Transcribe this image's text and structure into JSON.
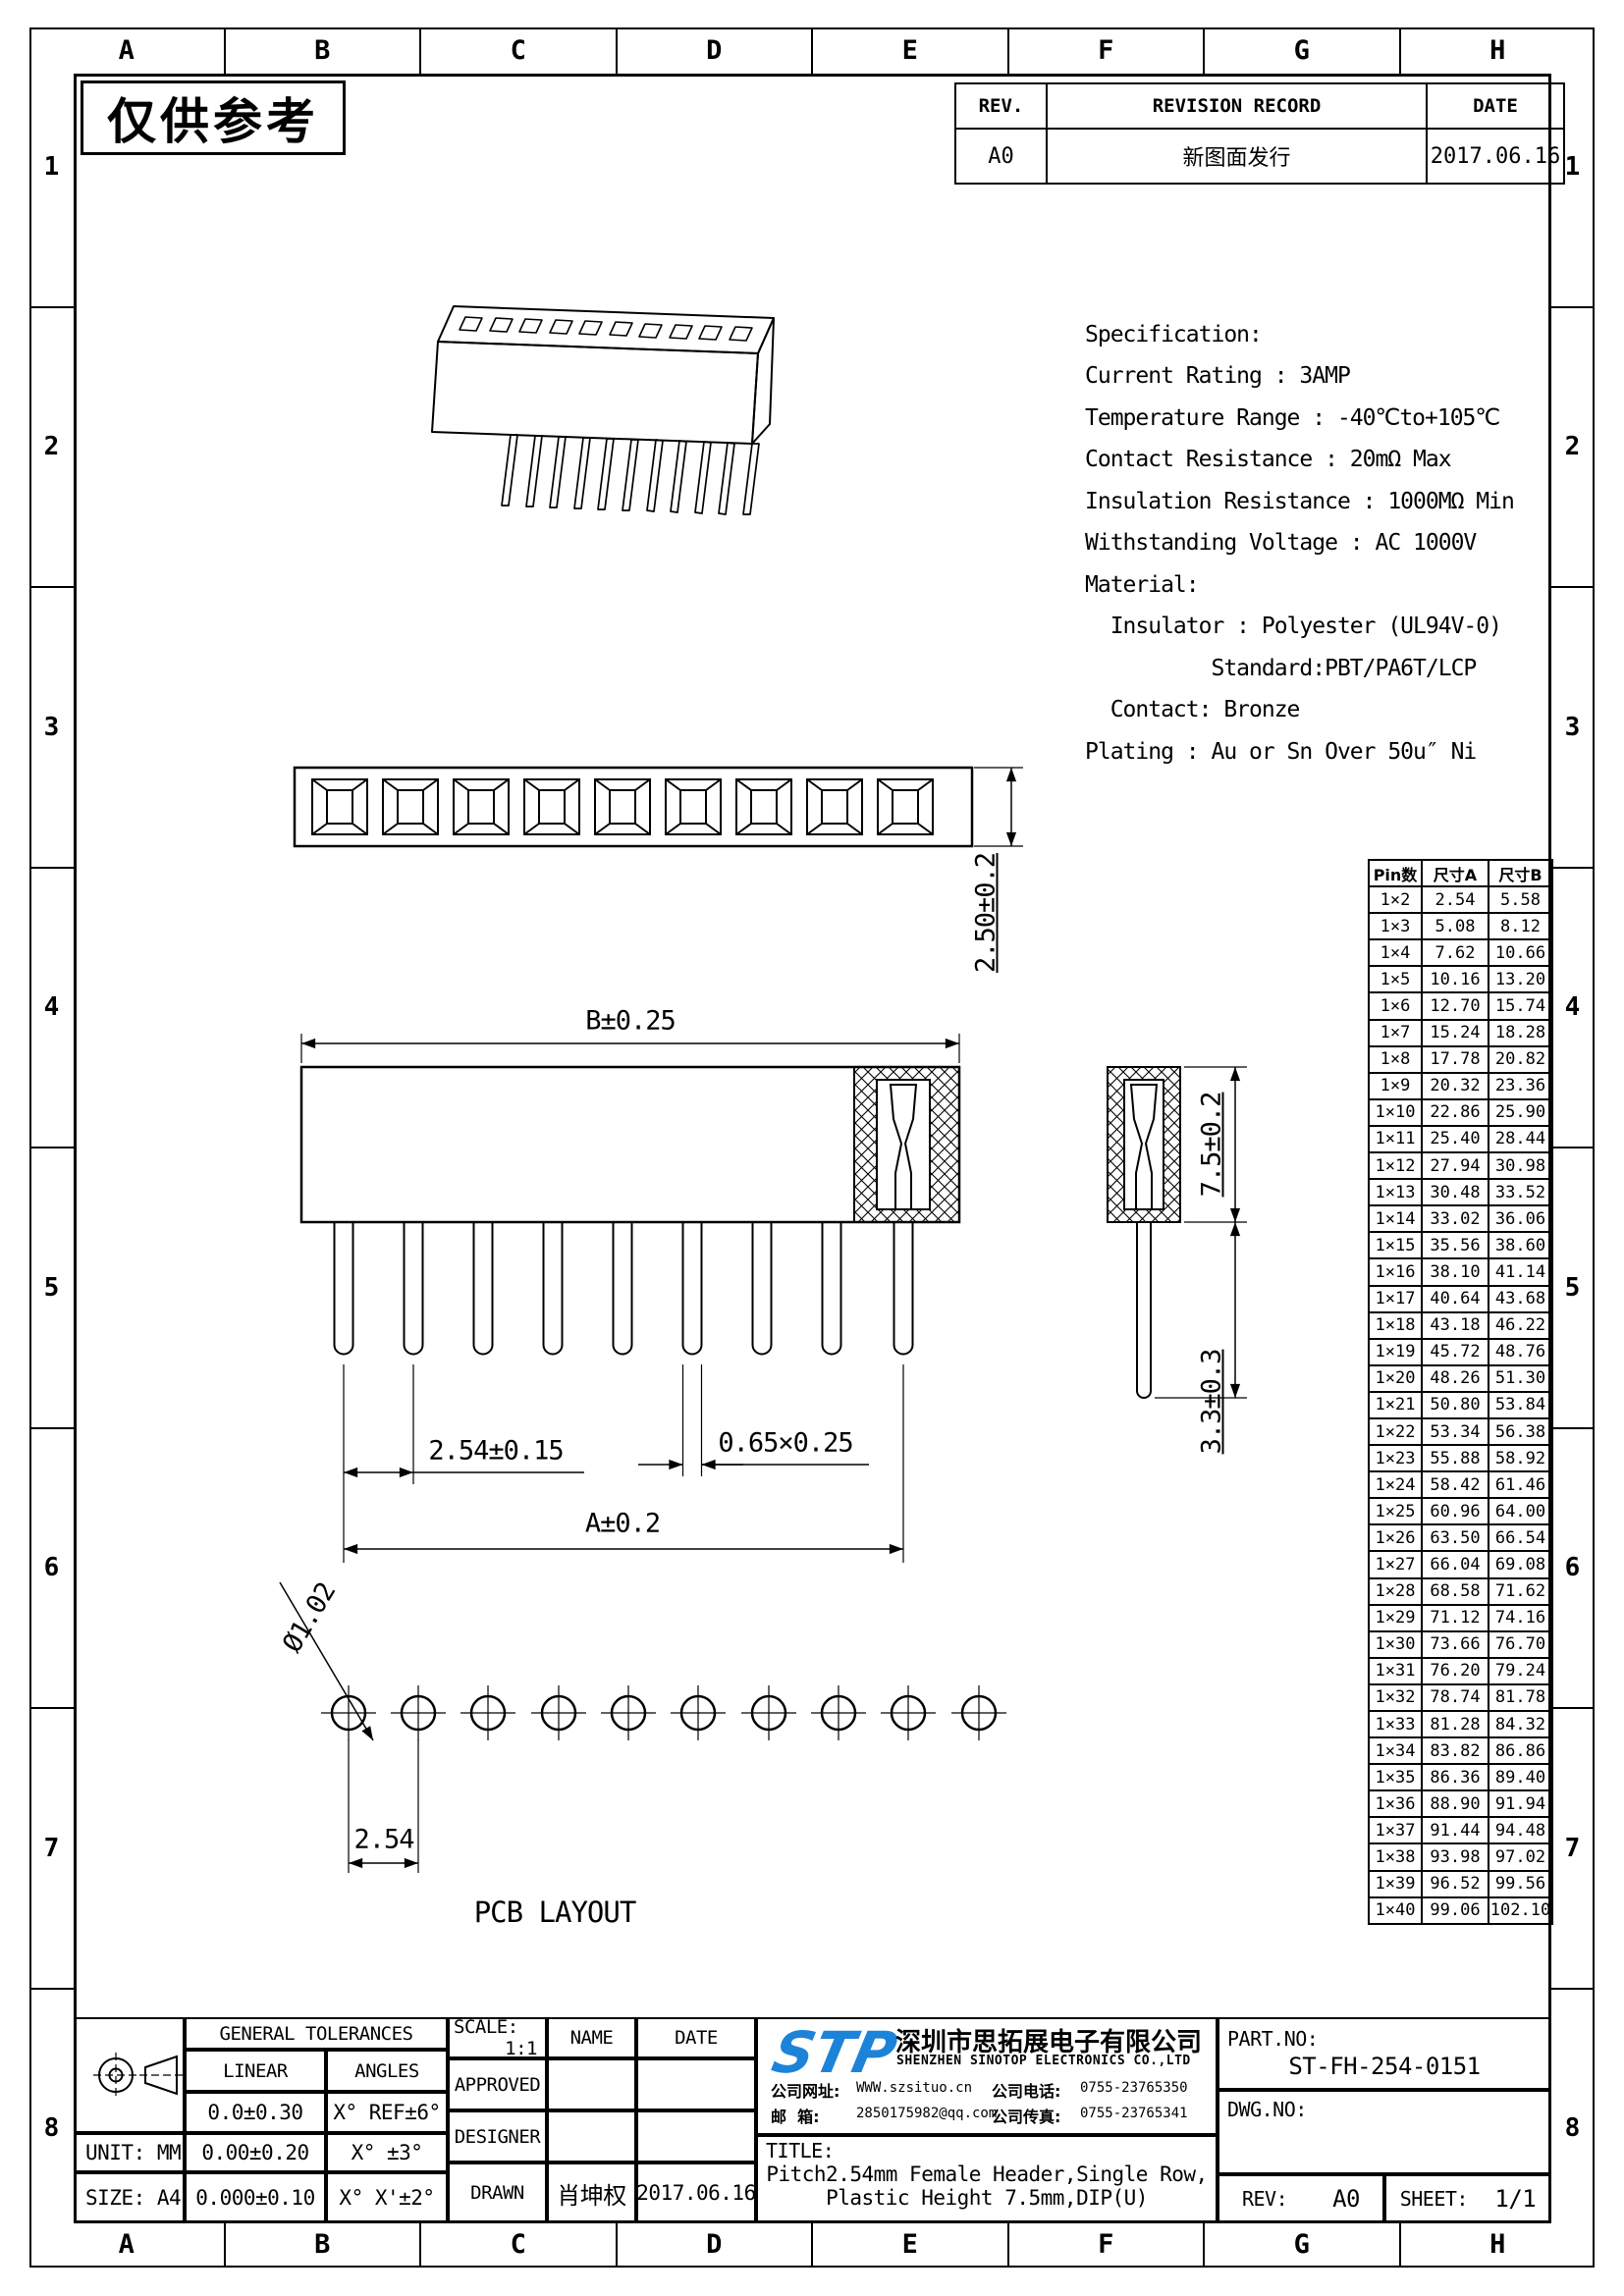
{
  "watermark": "仅供参考",
  "border": {
    "columns": [
      "A",
      "B",
      "C",
      "D",
      "E",
      "F",
      "G",
      "H"
    ],
    "rows": [
      "1",
      "2",
      "3",
      "4",
      "5",
      "6",
      "7",
      "8"
    ]
  },
  "revision": {
    "headers": [
      "REV.",
      "REVISION RECORD",
      "DATE"
    ],
    "rows": [
      [
        "A0",
        "新图面发行",
        "2017.06.16"
      ]
    ]
  },
  "specification": {
    "lines": [
      "Specification:",
      "Current Rating : 3AMP",
      "Temperature Range : -40℃to+105℃",
      "Contact Resistance : 20mΩ Max",
      "Insulation Resistance : 1000MΩ Min",
      "Withstanding Voltage : AC 1000V",
      "Material:",
      "  Insulator : Polyester (UL94V-0)",
      "          Standard:PBT/PA6T/LCP",
      "  Contact: Bronze",
      "Plating : Au or Sn Over 50u″ Ni"
    ]
  },
  "dimensions": {
    "top_view_height": "2.50±0.2",
    "body_width": "B±0.25",
    "pitch": "2.54±0.15",
    "pin_section": "0.65×0.25",
    "overall": "A±0.2",
    "insulator_height": "7.5±0.2",
    "pin_length": "3.3±0.3",
    "hole_dia": "Ø1.02",
    "hole_pitch": "2.54",
    "pcb_label": "PCB LAYOUT"
  },
  "pin_table": {
    "headers": [
      "Pin数",
      "尺寸A",
      "尺寸B"
    ],
    "rows": [
      [
        "1×2",
        "2.54",
        "5.58"
      ],
      [
        "1×3",
        "5.08",
        "8.12"
      ],
      [
        "1×4",
        "7.62",
        "10.66"
      ],
      [
        "1×5",
        "10.16",
        "13.20"
      ],
      [
        "1×6",
        "12.70",
        "15.74"
      ],
      [
        "1×7",
        "15.24",
        "18.28"
      ],
      [
        "1×8",
        "17.78",
        "20.82"
      ],
      [
        "1×9",
        "20.32",
        "23.36"
      ],
      [
        "1×10",
        "22.86",
        "25.90"
      ],
      [
        "1×11",
        "25.40",
        "28.44"
      ],
      [
        "1×12",
        "27.94",
        "30.98"
      ],
      [
        "1×13",
        "30.48",
        "33.52"
      ],
      [
        "1×14",
        "33.02",
        "36.06"
      ],
      [
        "1×15",
        "35.56",
        "38.60"
      ],
      [
        "1×16",
        "38.10",
        "41.14"
      ],
      [
        "1×17",
        "40.64",
        "43.68"
      ],
      [
        "1×18",
        "43.18",
        "46.22"
      ],
      [
        "1×19",
        "45.72",
        "48.76"
      ],
      [
        "1×20",
        "48.26",
        "51.30"
      ],
      [
        "1×21",
        "50.80",
        "53.84"
      ],
      [
        "1×22",
        "53.34",
        "56.38"
      ],
      [
        "1×23",
        "55.88",
        "58.92"
      ],
      [
        "1×24",
        "58.42",
        "61.46"
      ],
      [
        "1×25",
        "60.96",
        "64.00"
      ],
      [
        "1×26",
        "63.50",
        "66.54"
      ],
      [
        "1×27",
        "66.04",
        "69.08"
      ],
      [
        "1×28",
        "68.58",
        "71.62"
      ],
      [
        "1×29",
        "71.12",
        "74.16"
      ],
      [
        "1×30",
        "73.66",
        "76.70"
      ],
      [
        "1×31",
        "76.20",
        "79.24"
      ],
      [
        "1×32",
        "78.74",
        "81.78"
      ],
      [
        "1×33",
        "81.28",
        "84.32"
      ],
      [
        "1×34",
        "83.82",
        "86.86"
      ],
      [
        "1×35",
        "86.36",
        "89.40"
      ],
      [
        "1×36",
        "88.90",
        "91.94"
      ],
      [
        "1×37",
        "91.44",
        "94.48"
      ],
      [
        "1×38",
        "93.98",
        "97.02"
      ],
      [
        "1×39",
        "96.52",
        "99.56"
      ],
      [
        "1×40",
        "99.06",
        "102.10"
      ]
    ]
  },
  "title_block": {
    "tolerances_title": "GENERAL TOLERANCES",
    "linear_header": "LINEAR",
    "angles_header": "ANGLES",
    "tolerance_rows": [
      [
        "0.0±0.30",
        "X° REF±6°"
      ],
      [
        "0.00±0.20",
        "X° ±3°"
      ],
      [
        "0.000±0.10",
        "X° X'±2°"
      ]
    ],
    "unit": "UNIT: MM",
    "size": "SIZE: A4",
    "scale_label": "SCALE:",
    "scale_value": "1:1",
    "name_header": "NAME",
    "date_header": "DATE",
    "approved_label": "APPROVED",
    "designer_label": "DESIGNER",
    "drawn_label": "DRAWN",
    "drawn_name": "肖坤权",
    "drawn_date": "2017.06.16",
    "logo_text": "STP",
    "company_cn": "深圳市思拓展电子有限公司",
    "company_en": "SHENZHEN SINOTOP ELECTRONICS CO.,LTD",
    "website_label": "公司网址:",
    "website": "WWW.szsituo.cn",
    "phone_label": "公司电话:",
    "phone": "0755-23765350",
    "email_label": "邮  箱:",
    "email": "2850175982@qq.com",
    "fax_label": "公司传真:",
    "fax": "0755-23765341",
    "title_label": "TITLE:",
    "title_line1": "Pitch2.54mm Female Header,Single Row,",
    "title_line2": "Plastic Height 7.5mm,DIP(U)",
    "partno_label": "PART.NO:",
    "partno": "ST-FH-254-0151",
    "dwgno_label": "DWG.NO:",
    "rev_label": "REV:",
    "rev_value": "A0",
    "sheet_label": "SHEET:",
    "sheet_value": "1/1"
  },
  "colors": {
    "ink": "#000000",
    "logo_blue": "#1d83d8"
  }
}
